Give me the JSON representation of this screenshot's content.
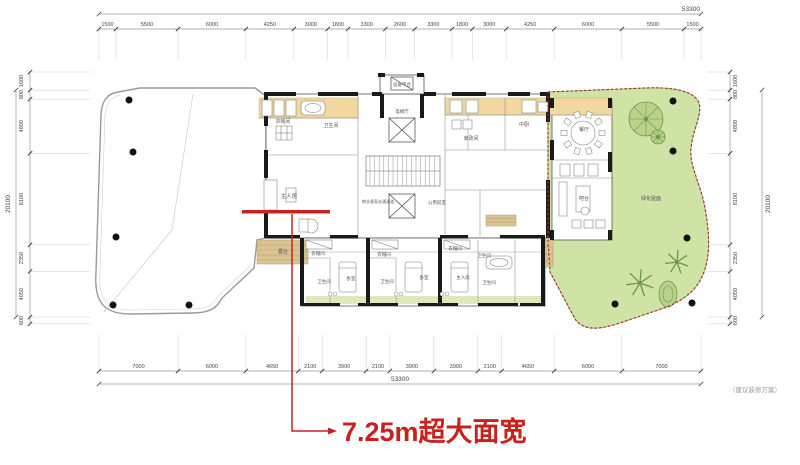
{
  "annotation": {
    "highlight_text": "7.25m超大面宽",
    "note": "（建议装修方案）"
  },
  "dimensions": {
    "total_width": "53300",
    "total_height": "20100",
    "top": [
      "1500",
      "5500",
      "6000",
      "4250",
      "3000",
      "1800",
      "3300",
      "2600",
      "3300",
      "1800",
      "3000",
      "4250",
      "6000",
      "5500",
      "1500"
    ],
    "bottom": [
      "7000",
      "6000",
      "4650",
      "2100",
      "3900",
      "2100",
      "3900",
      "3900",
      "2100",
      "4650",
      "6000",
      "7000"
    ],
    "left": [
      "1600",
      "800",
      "4800",
      "8100",
      "2350",
      "4050",
      "600"
    ],
    "right": [
      "1600",
      "800",
      "4800",
      "8100",
      "2350",
      "4050",
      "600"
    ]
  },
  "rooms": [
    {
      "t": "衣帽间",
      "x": 283,
      "y": 123,
      "s": 5
    },
    {
      "t": "卫生间",
      "x": 331,
      "y": 127,
      "s": 5
    },
    {
      "t": "主人房",
      "x": 289,
      "y": 198,
      "s": 5.5
    },
    {
      "t": "露台",
      "x": 283,
      "y": 253,
      "s": 5
    },
    {
      "t": "设备平台",
      "x": 402,
      "y": 86,
      "s": 4.5
    },
    {
      "t": "电梯厅",
      "x": 402,
      "y": 113,
      "s": 4.5
    },
    {
      "t": "公用前室",
      "x": 437,
      "y": 204,
      "s": 4.5
    },
    {
      "t": "物业垂直交通通道",
      "x": 378,
      "y": 203,
      "s": 4
    },
    {
      "t": "家政间",
      "x": 471,
      "y": 140,
      "s": 5
    },
    {
      "t": "中厨",
      "x": 524,
      "y": 126,
      "s": 5
    },
    {
      "t": "餐厅",
      "x": 584,
      "y": 131,
      "s": 5
    },
    {
      "t": "吧台",
      "x": 584,
      "y": 200,
      "s": 5
    },
    {
      "t": "绿化屋面",
      "x": 651,
      "y": 200,
      "s": 5
    },
    {
      "t": "衣帽间",
      "x": 318,
      "y": 255,
      "s": 4.5
    },
    {
      "t": "卫生间",
      "x": 324,
      "y": 283,
      "s": 4.5
    },
    {
      "t": "卧室",
      "x": 351,
      "y": 280,
      "s": 4.5
    },
    {
      "t": "衣帽间",
      "x": 384,
      "y": 256,
      "s": 4.5
    },
    {
      "t": "卫生间",
      "x": 387,
      "y": 283,
      "s": 4.5
    },
    {
      "t": "卧室",
      "x": 424,
      "y": 279,
      "s": 4.5
    },
    {
      "t": "衣帽间",
      "x": 455,
      "y": 250,
      "s": 4.5
    },
    {
      "t": "主人房",
      "x": 463,
      "y": 279,
      "s": 4.5
    },
    {
      "t": "卫生间",
      "x": 484,
      "y": 257,
      "s": 4.5
    },
    {
      "t": "卫生间",
      "x": 489,
      "y": 284,
      "s": 4.5
    }
  ],
  "colors": {
    "highlight_red": "#c9211e",
    "boundary_red": "#a83232",
    "garden_green": "#cfe3a4",
    "tree_green": "#b9d28b",
    "room_orange": "#f2d8a0",
    "deck_wood": "#dbc493",
    "balcony_green": "#dde9bb",
    "wall_black": "#1a1a1a"
  }
}
